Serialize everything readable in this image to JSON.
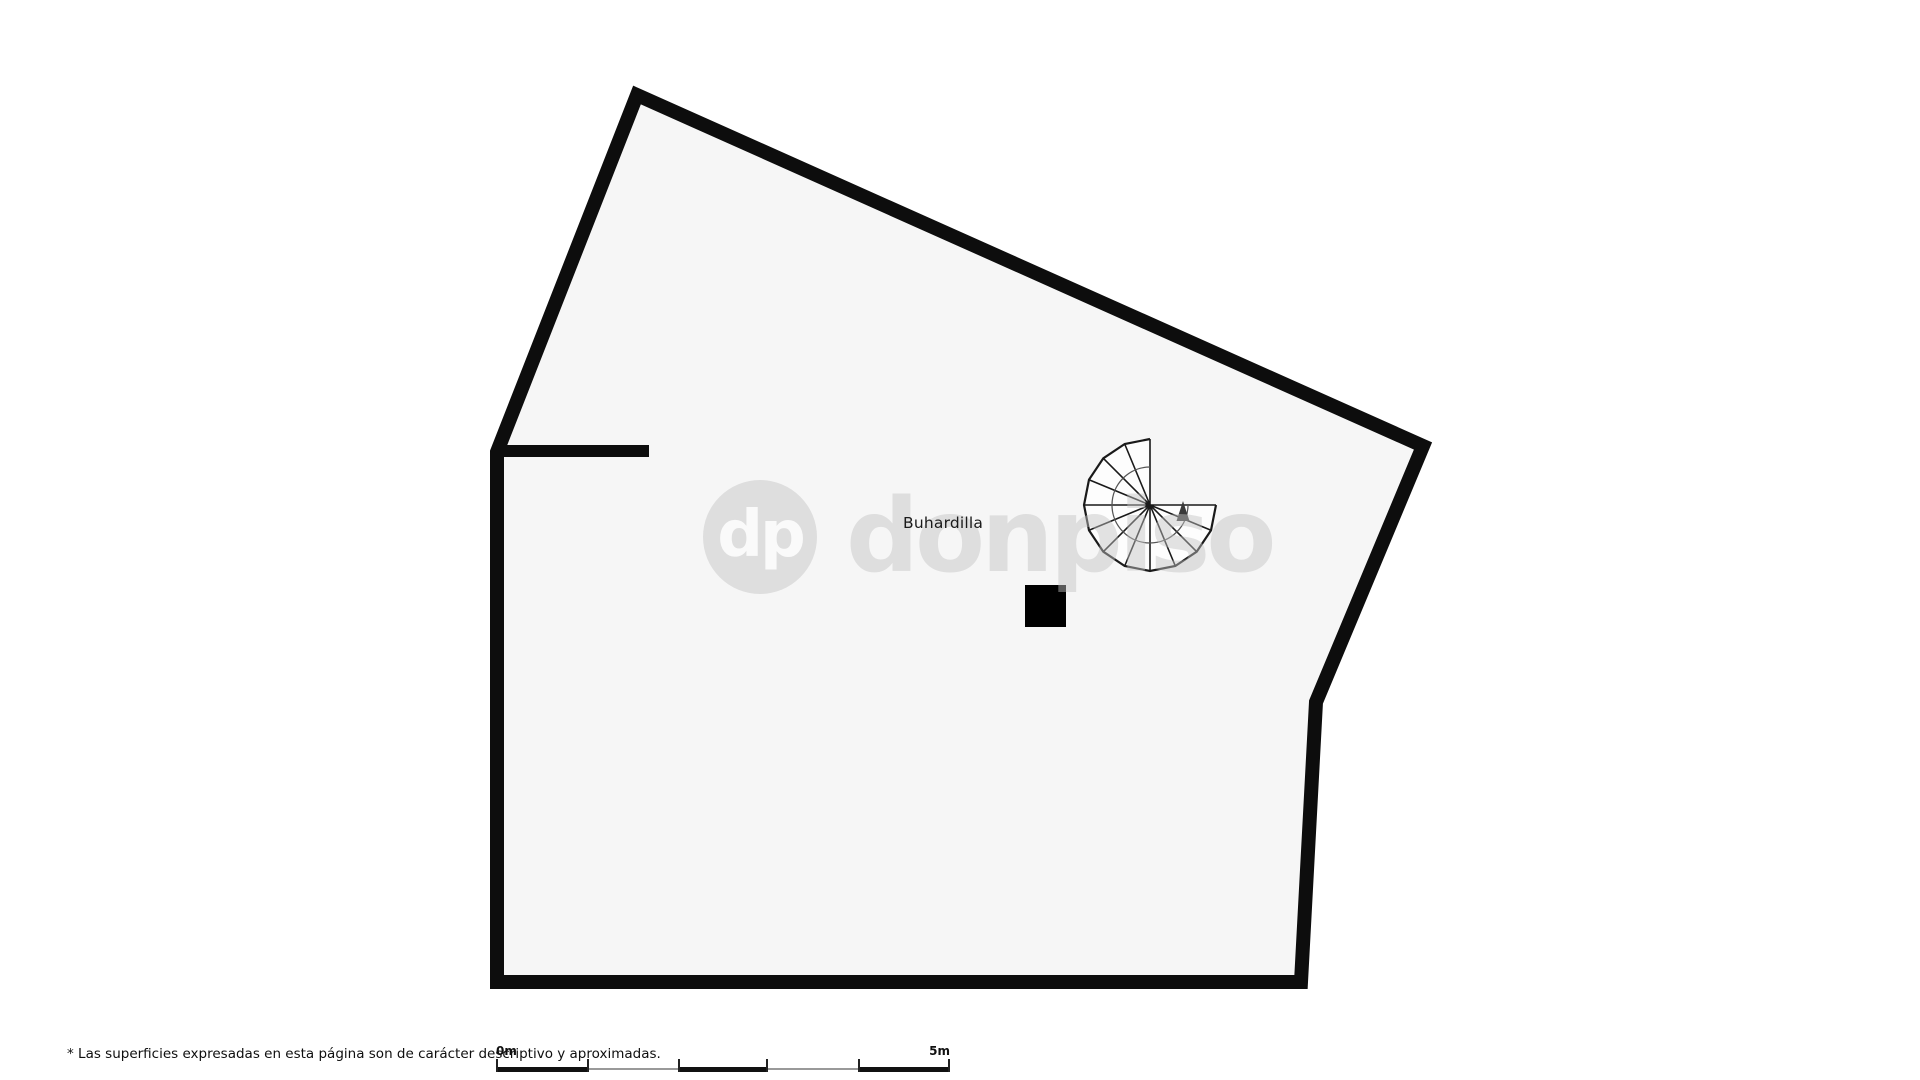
{
  "plan": {
    "room_label": "Buhardilla"
  },
  "watermark": {
    "logo_initials": "dp",
    "logo_text": "donpiso"
  },
  "footer": {
    "disclaimer": "* Las superficies expresadas en esta página son de carácter descriptivo y aproximadas.",
    "scale": {
      "start_label": "0m",
      "end_label": "5m"
    }
  },
  "colors": {
    "page-bg": "#ffffff",
    "plan-fill": "#f6f6f6",
    "wall": "#0d0d0d",
    "stair-line": "#1a1a1a",
    "watermark-grey": "#c3c3c3",
    "label-text": "#1a1a1a",
    "scale-grey": "#999999"
  }
}
